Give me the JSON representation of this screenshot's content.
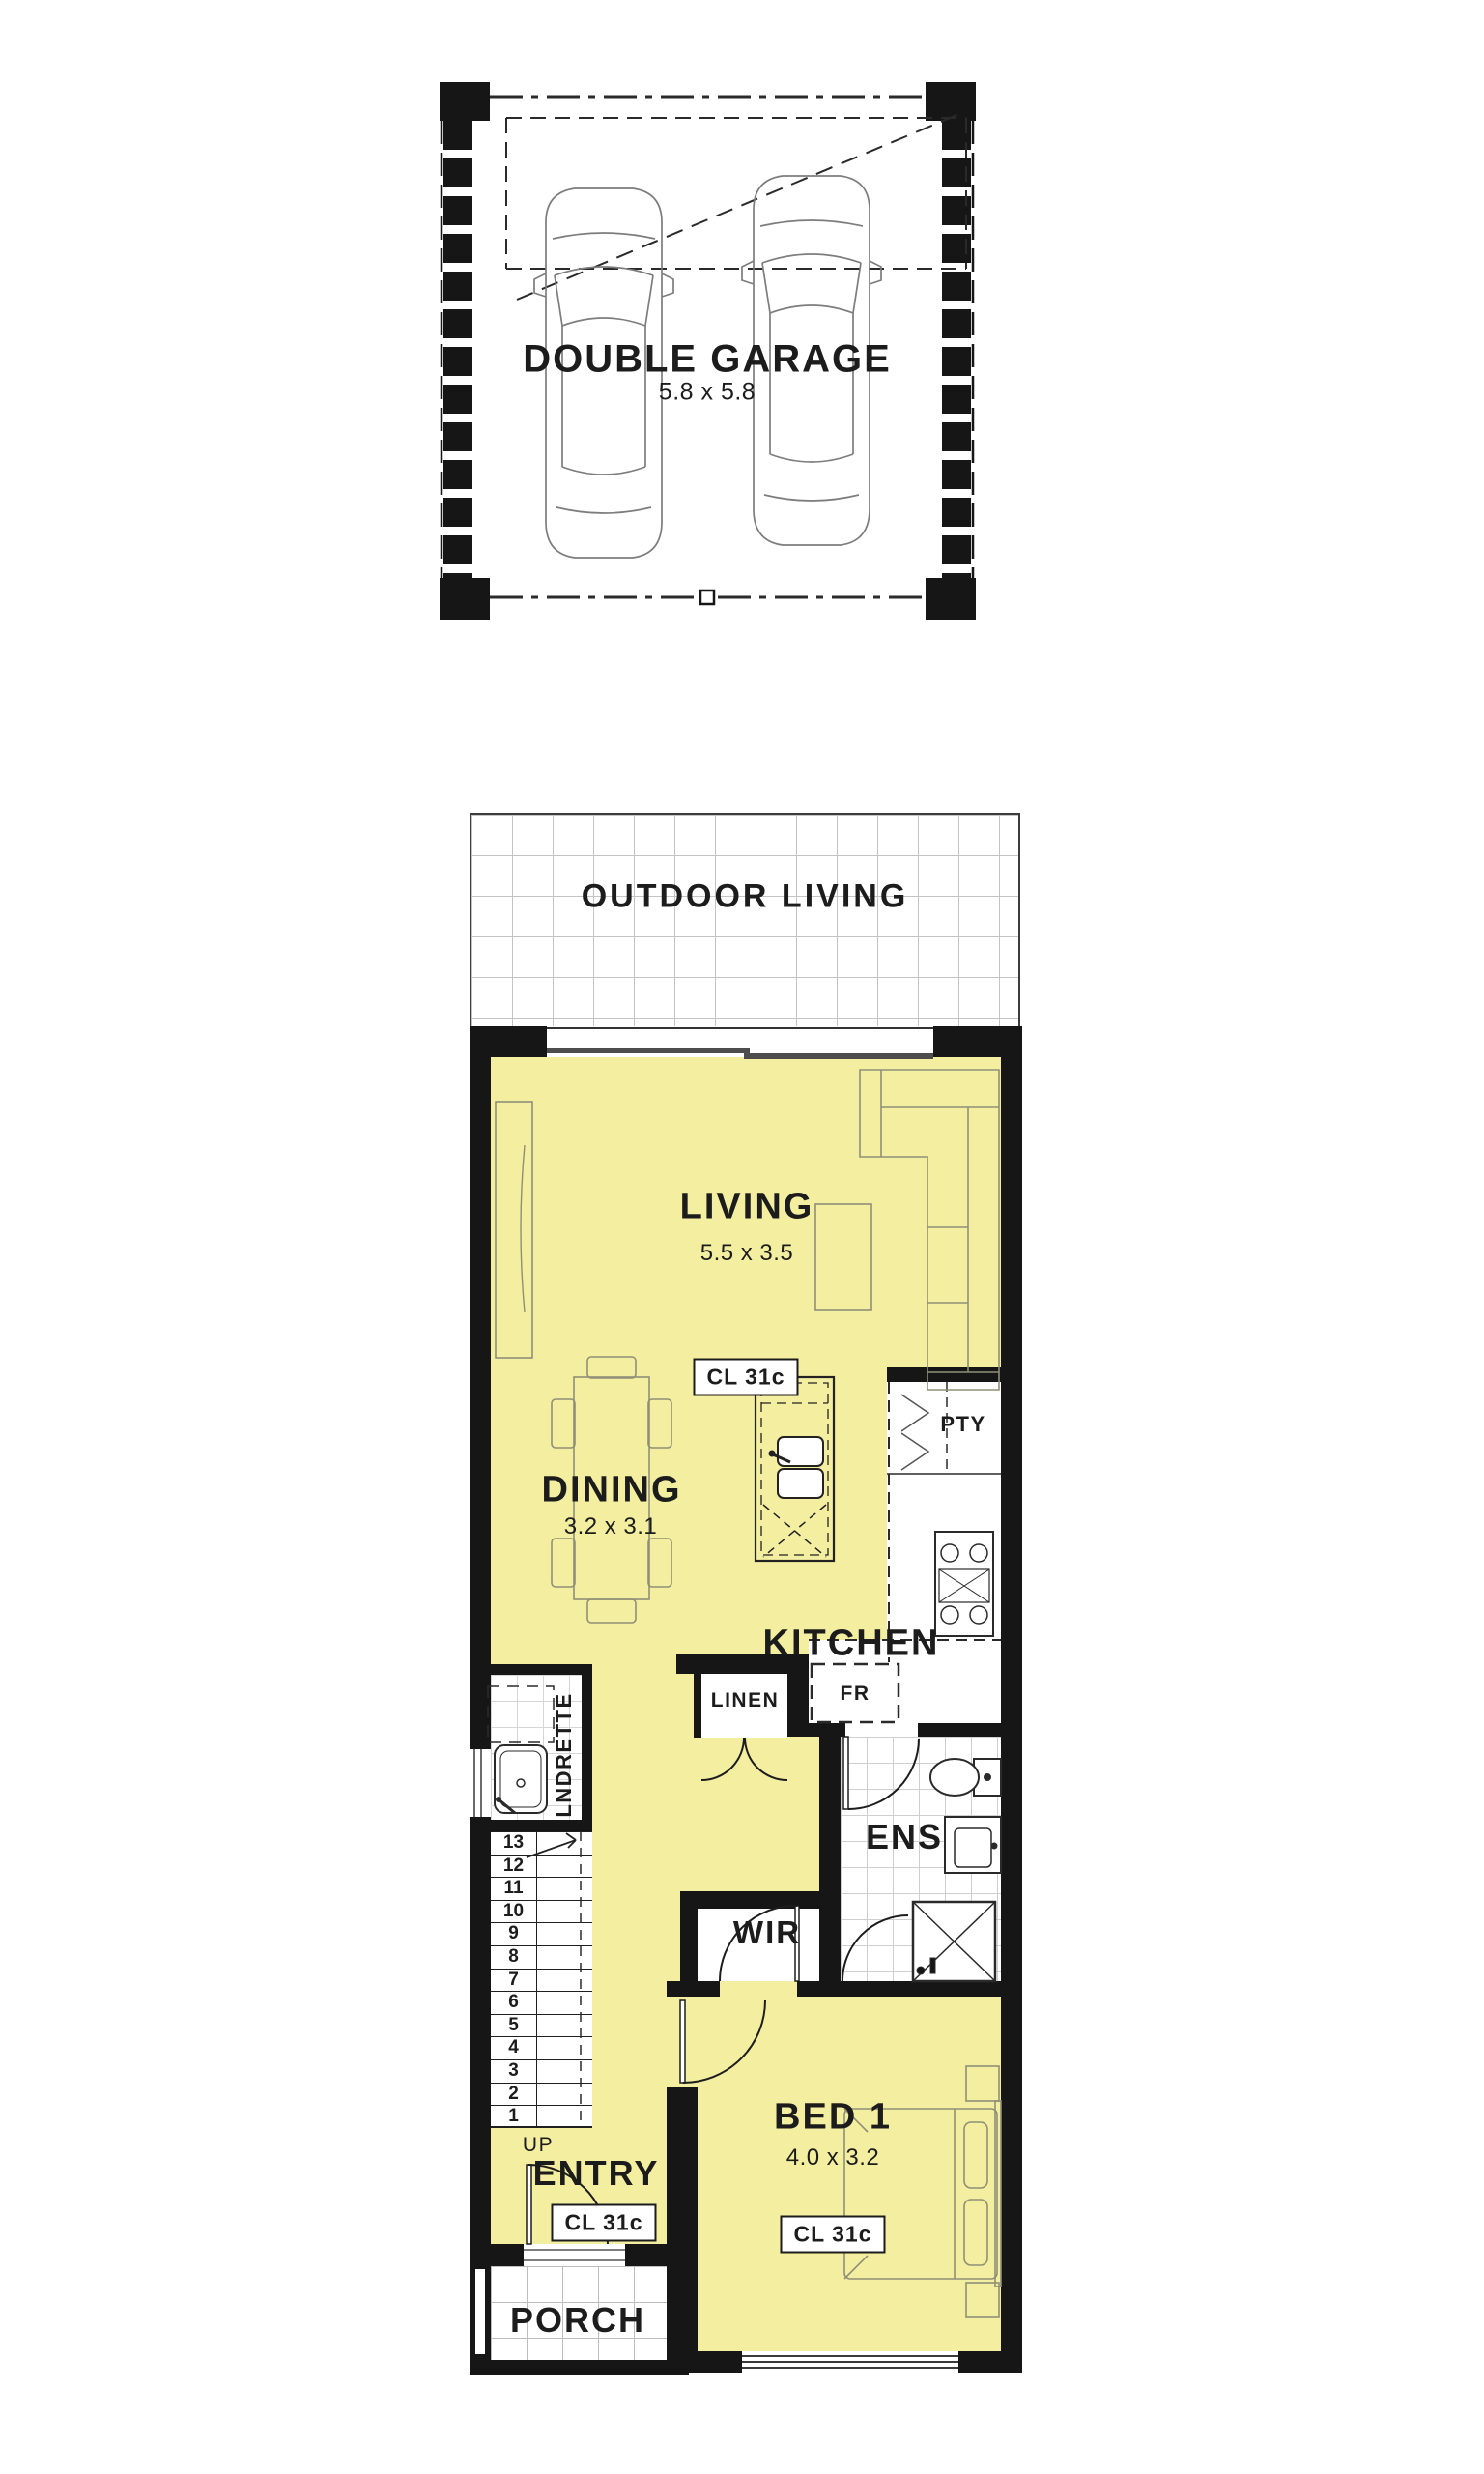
{
  "floorplan": {
    "garage": {
      "label": "DOUBLE GARAGE",
      "dims": "5.8 x 5.8"
    },
    "outdoor_living": {
      "label": "OUTDOOR LIVING"
    },
    "living": {
      "label": "LIVING",
      "dims": "5.5 x 3.5",
      "ceiling": "CL 31c"
    },
    "dining": {
      "label": "DINING",
      "dims": "3.2 x 3.1"
    },
    "kitchen": {
      "label": "KITCHEN"
    },
    "pantry": {
      "label": "PTY"
    },
    "linen": {
      "label": "LINEN"
    },
    "fridge": {
      "label": "FR"
    },
    "laundrette": {
      "label": "LNDRETTE"
    },
    "stairs": {
      "up_label": "UP",
      "treads": [
        "13",
        "12",
        "11",
        "10",
        "9",
        "8",
        "7",
        "6",
        "5",
        "4",
        "3",
        "2",
        "1"
      ]
    },
    "wir": {
      "label": "WIR"
    },
    "ensuite": {
      "label": "ENS"
    },
    "entry": {
      "label": "ENTRY",
      "ceiling": "CL 31c"
    },
    "bed1": {
      "label": "BED 1",
      "dims": "4.0 x 3.2",
      "ceiling": "CL 31c"
    },
    "porch": {
      "label": "PORCH"
    },
    "colors": {
      "floor": "#f4efa0",
      "wall": "#161616",
      "tile_line": "#c4c4c4",
      "furniture_line": "#8f8f78"
    }
  }
}
